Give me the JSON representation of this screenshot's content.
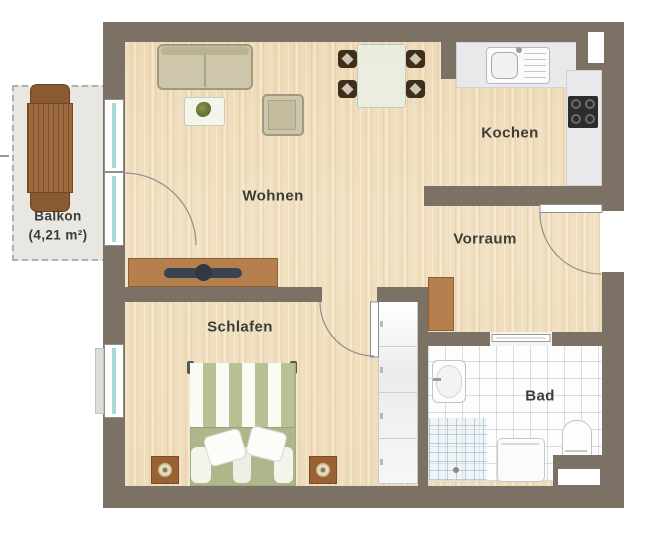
{
  "plan": {
    "type": "apartment-floor-plan",
    "labels": {
      "balkon": "Balkon",
      "balkon_area": "(4,21 m²)",
      "wohnen": "Wohnen",
      "kochen": "Kochen",
      "vorraum": "Vorraum",
      "schlafen": "Schlafen",
      "bad": "Bad"
    },
    "colors": {
      "wall": "#7b7265",
      "wood_floor": "#f1e1c2",
      "bath_tile": "#fdfdfe",
      "tile_grid": "#aac0d0",
      "balcony_floor": "#e9e7e1",
      "furniture_wood": "#b5804e",
      "upholstery": "#cdc6aa",
      "bed_green": "#aeb78b",
      "glass": "#a8d8da",
      "label_text": "#3c3c38"
    },
    "icons": [
      "sofa-icon",
      "armchair-icon",
      "coffee-table-icon",
      "plant-icon",
      "dining-table-icon",
      "dining-chair-icon",
      "balcony-table-icon",
      "balcony-chair-icon",
      "kitchen-sink-icon",
      "stove-icon",
      "sideboard-icon",
      "tv-icon",
      "wardrobe-icon",
      "bed-icon",
      "pillow-icon",
      "nightstand-icon",
      "lamp-icon",
      "washbasin-icon",
      "toilet-icon",
      "washing-machine-icon",
      "shower-icon",
      "door-arc-icon",
      "window-icon"
    ]
  }
}
